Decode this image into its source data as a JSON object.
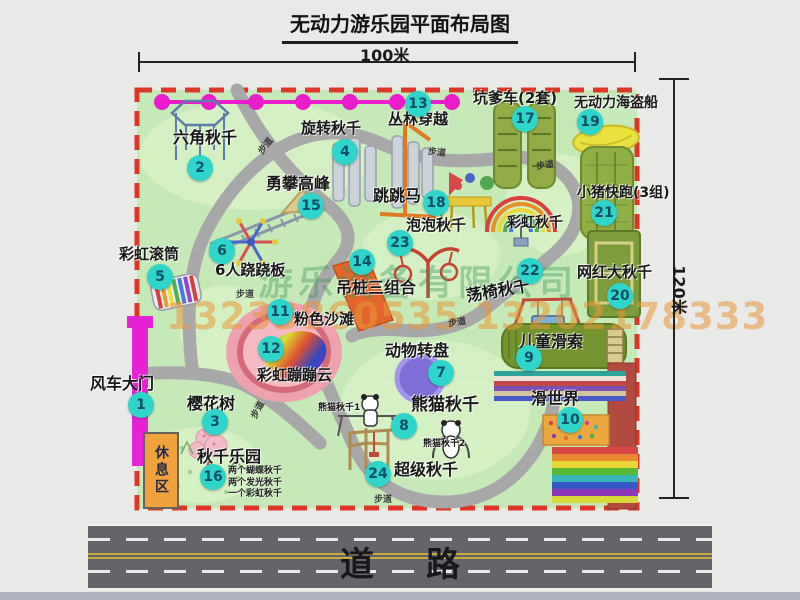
{
  "title": "无动力游乐园平面布局图",
  "dimensions": {
    "width_label": "100米",
    "height_label": "120米"
  },
  "road": {
    "label": "道路"
  },
  "watermark": {
    "company": "游乐设备有限公司",
    "phone": "13233860535 13202178333"
  },
  "rest_area_label": "休息区",
  "colors": {
    "badge-bg": "#2ed5cb",
    "badge-text": "#0d4f66",
    "park-green": "#c6e9b8",
    "border-red": "#dd3626",
    "path-gray": "#a8a8a8",
    "gate-magenta": "#e522d4",
    "chain-magenta": "#ea1ccb",
    "road-gray": "#64656b",
    "rest-orange": "#f2a23c",
    "beach-pink": "#eda2ae",
    "turntable-purple": "#7e6ed8",
    "boat-yellow": "#e9e13e"
  },
  "map": {
    "path_label_text": "步道",
    "items": [
      {
        "num": 1,
        "label": "风车大门",
        "lx": 90,
        "ly": 376,
        "bx": 141,
        "by": 405,
        "size": 16
      },
      {
        "num": 2,
        "label": "六角秋千",
        "lx": 173,
        "ly": 130,
        "bx": 200,
        "by": 168,
        "size": 16
      },
      {
        "num": 3,
        "label": "樱花树",
        "lx": 187,
        "ly": 396,
        "bx": 215,
        "by": 422,
        "size": 16
      },
      {
        "num": 4,
        "label": "旋转秋千",
        "lx": 301,
        "ly": 121,
        "bx": 345,
        "by": 152,
        "size": 15
      },
      {
        "num": 5,
        "label": "彩虹滚筒",
        "lx": 119,
        "ly": 247,
        "bx": 160,
        "by": 277,
        "size": 15
      },
      {
        "num": 6,
        "label": "6人跷跷板",
        "lx": 215,
        "ly": 263,
        "bx": 222,
        "by": 251,
        "size": 15
      },
      {
        "num": 7,
        "label": "动物转盘",
        "lx": 385,
        "ly": 343,
        "bx": 441,
        "by": 373,
        "size": 16
      },
      {
        "num": 8,
        "label": "熊猫秋千",
        "lx": 411,
        "ly": 397,
        "bx": 404,
        "by": 426,
        "size": 17
      },
      {
        "num": 9,
        "label": "儿童滑索",
        "lx": 519,
        "ly": 334,
        "bx": 529,
        "by": 358,
        "size": 16
      },
      {
        "num": 10,
        "label": "滑世界",
        "lx": 531,
        "ly": 391,
        "bx": 570,
        "by": 420,
        "size": 16
      },
      {
        "num": 11,
        "label": "粉色沙滩",
        "lx": 294,
        "ly": 312,
        "bx": 280,
        "by": 312,
        "size": 15
      },
      {
        "num": 12,
        "label": "彩虹蹦蹦云",
        "lx": 257,
        "ly": 368,
        "bx": 271,
        "by": 349,
        "size": 15
      },
      {
        "num": 13,
        "label": "丛林穿越",
        "lx": 388,
        "ly": 112,
        "bx": 418,
        "by": 104,
        "size": 15
      },
      {
        "num": 14,
        "label": "吊桩三组合",
        "lx": 336,
        "ly": 280,
        "bx": 362,
        "by": 262,
        "size": 16
      },
      {
        "num": 15,
        "label": "勇攀高峰",
        "lx": 266,
        "ly": 176,
        "bx": 311,
        "by": 206,
        "size": 16
      },
      {
        "num": 16,
        "label": "秋千乐园",
        "lx": 197,
        "ly": 449,
        "bx": 213,
        "by": 477,
        "size": 16,
        "sx": 228,
        "sy": 466,
        "subs": [
          "两个蝴蝶秋千",
          "两个发光秋千",
          "一个彩虹秋千"
        ]
      },
      {
        "num": 17,
        "label": "坑爹车(2套)",
        "lx": 473,
        "ly": 91,
        "bx": 525,
        "by": 119,
        "size": 15
      },
      {
        "num": 18,
        "label": "跳跳马",
        "lx": 373,
        "ly": 188,
        "bx": 436,
        "by": 203,
        "size": 16
      },
      {
        "num": 19,
        "label": "无动力海盗船",
        "lx": 574,
        "ly": 96,
        "bx": 590,
        "by": 122,
        "size": 14
      },
      {
        "num": 20,
        "label": "网红大秋千",
        "lx": 577,
        "ly": 265,
        "bx": 620,
        "by": 296,
        "size": 15
      },
      {
        "num": 21,
        "label": "小猪快跑(3组)",
        "lx": 577,
        "ly": 186,
        "bx": 604,
        "by": 213,
        "size": 14
      },
      {
        "num": 22,
        "label": "荡椅秋千",
        "lx": 466,
        "ly": 283,
        "bx": 530,
        "by": 271,
        "size": 16,
        "rot": -10
      },
      {
        "num": 23,
        "label": "泡泡秋千",
        "lx": 406,
        "ly": 218,
        "bx": 400,
        "by": 243,
        "size": 15
      },
      {
        "num": 24,
        "label": "超级秋千",
        "lx": 394,
        "ly": 462,
        "bx": 378,
        "by": 474,
        "size": 16
      }
    ],
    "extra_labels": [
      {
        "label": "彩虹秋千",
        "x": 507,
        "y": 216,
        "size": 14
      },
      {
        "label": "熊猫秋千1",
        "x": 318,
        "y": 404,
        "size": 9
      },
      {
        "label": "熊猫秋千2",
        "x": 423,
        "y": 440,
        "size": 9
      }
    ],
    "path_labels": [
      {
        "x": 256,
        "y": 139,
        "rot": -52
      },
      {
        "x": 428,
        "y": 145,
        "rot": 6
      },
      {
        "x": 536,
        "y": 158,
        "rot": -8
      },
      {
        "x": 236,
        "y": 287,
        "rot": 0
      },
      {
        "x": 448,
        "y": 315,
        "rot": -8
      },
      {
        "x": 248,
        "y": 403,
        "rot": -62
      },
      {
        "x": 374,
        "y": 492,
        "rot": 0
      }
    ]
  }
}
